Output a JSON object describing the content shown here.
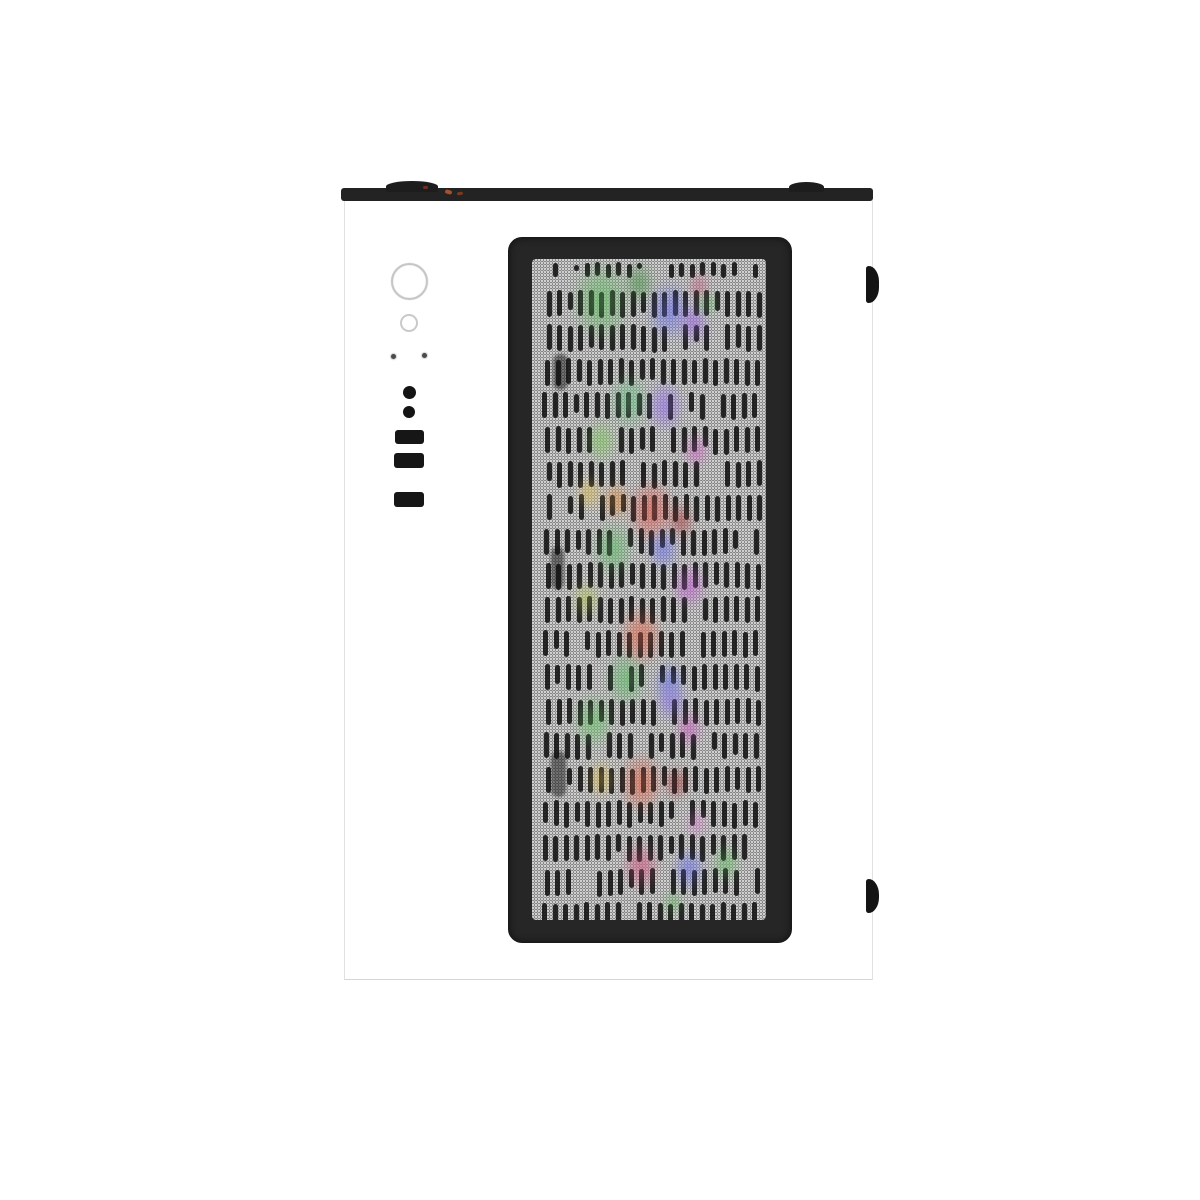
{
  "image": {
    "background_color": "#ffffff",
    "subject": "white-pc-tower-case-top-down-product-photo"
  },
  "case": {
    "body_color": "#ffffff",
    "edge_color": "#e2e2e2",
    "top_bar_color": "#232323",
    "latch_tab_color": "#141414",
    "cable_accent_colors": [
      "#a8502a",
      "#7a3a20",
      "#6e3020"
    ]
  },
  "io_panel": {
    "controls": [
      {
        "name": "power-button",
        "shape": "circle-outline",
        "color": "#c6c6c6"
      },
      {
        "name": "reset-button",
        "shape": "circle-outline",
        "color": "#c9c9c9"
      },
      {
        "name": "led-indicator-left",
        "shape": "dot",
        "color": "#4a4a4a"
      },
      {
        "name": "led-indicator-right",
        "shape": "dot",
        "color": "#4a4a4a"
      },
      {
        "name": "audio-jack-mic",
        "shape": "filled-circle",
        "color": "#141414"
      },
      {
        "name": "audio-jack-headphone",
        "shape": "filled-circle",
        "color": "#141414"
      },
      {
        "name": "usb-port-1",
        "shape": "rect",
        "color": "#161616"
      },
      {
        "name": "usb-port-2",
        "shape": "rect",
        "color": "#161616"
      },
      {
        "name": "usb-port-3",
        "shape": "rect",
        "color": "#161616"
      }
    ]
  },
  "mesh_panel": {
    "frame_color": "#262626",
    "mesh_light_dot": "#d2d2d2",
    "mesh_dark_base": "#3a3a3a",
    "slot_color": "rgba(12,12,12,0.85)",
    "slot_rows": {
      "seed": 42,
      "start_y": 4,
      "first_row_height": 14,
      "second_row_y": 32,
      "row_pitch": 34,
      "slot_height": 26,
      "x_start": 12,
      "x_end": 222,
      "slot_pitch": 10.5,
      "slot_width": 5,
      "skip_chance": 0.1,
      "area_height": 661
    },
    "shadow_pillars": [
      {
        "x": 21,
        "y": 95,
        "w": 15,
        "h": 36
      },
      {
        "x": 19,
        "y": 288,
        "w": 13,
        "h": 42
      },
      {
        "x": 19,
        "y": 492,
        "w": 15,
        "h": 46
      }
    ]
  },
  "rgb_glows": [
    {
      "x": 69,
      "y": 42,
      "r": 38,
      "color": "#4e9a4e"
    },
    {
      "x": 107,
      "y": 24,
      "r": 20,
      "color": "#3f7a3f"
    },
    {
      "x": 137,
      "y": 52,
      "r": 28,
      "color": "#5a5fc8"
    },
    {
      "x": 161,
      "y": 64,
      "r": 20,
      "color": "#8055c0"
    },
    {
      "x": 175,
      "y": 45,
      "r": 12,
      "color": "#4e9a4e"
    },
    {
      "x": 167,
      "y": 27,
      "r": 14,
      "color": "#a85570"
    },
    {
      "x": 97,
      "y": 142,
      "r": 26,
      "color": "#57a06a"
    },
    {
      "x": 69,
      "y": 182,
      "r": 20,
      "color": "#6aa84f"
    },
    {
      "x": 133,
      "y": 147,
      "r": 24,
      "color": "#7a5cc8"
    },
    {
      "x": 164,
      "y": 192,
      "r": 16,
      "color": "#b055a8"
    },
    {
      "x": 57,
      "y": 234,
      "r": 16,
      "color": "#c0a24a"
    },
    {
      "x": 84,
      "y": 242,
      "r": 18,
      "color": "#c07838"
    },
    {
      "x": 119,
      "y": 252,
      "r": 30,
      "color": "#bf4a42"
    },
    {
      "x": 149,
      "y": 262,
      "r": 18,
      "color": "#8f3b3b"
    },
    {
      "x": 81,
      "y": 290,
      "r": 26,
      "color": "#4f9a55"
    },
    {
      "x": 131,
      "y": 290,
      "r": 20,
      "color": "#5a5fc8"
    },
    {
      "x": 157,
      "y": 327,
      "r": 22,
      "color": "#a050b0"
    },
    {
      "x": 54,
      "y": 340,
      "r": 18,
      "color": "#9aa84f"
    },
    {
      "x": 109,
      "y": 377,
      "r": 28,
      "color": "#c05540"
    },
    {
      "x": 94,
      "y": 420,
      "r": 26,
      "color": "#4f9a55"
    },
    {
      "x": 137,
      "y": 424,
      "r": 20,
      "color": "#5560c0"
    },
    {
      "x": 61,
      "y": 462,
      "r": 26,
      "color": "#55a055"
    },
    {
      "x": 139,
      "y": 442,
      "r": 20,
      "color": "#6f5fc8"
    },
    {
      "x": 157,
      "y": 470,
      "r": 18,
      "color": "#a84fa0"
    },
    {
      "x": 69,
      "y": 520,
      "r": 18,
      "color": "#c0a24a"
    },
    {
      "x": 109,
      "y": 524,
      "r": 28,
      "color": "#c05540"
    },
    {
      "x": 144,
      "y": 524,
      "r": 16,
      "color": "#8f3333"
    },
    {
      "x": 164,
      "y": 564,
      "r": 14,
      "color": "#bf6fb4"
    },
    {
      "x": 109,
      "y": 607,
      "r": 24,
      "color": "#b04a6a"
    },
    {
      "x": 157,
      "y": 610,
      "r": 20,
      "color": "#5a5fc8"
    },
    {
      "x": 194,
      "y": 604,
      "r": 18,
      "color": "#55a055"
    },
    {
      "x": 141,
      "y": 644,
      "r": 12,
      "color": "#55a055"
    }
  ],
  "side_tabs": {
    "count": 2,
    "color": "#141414"
  }
}
